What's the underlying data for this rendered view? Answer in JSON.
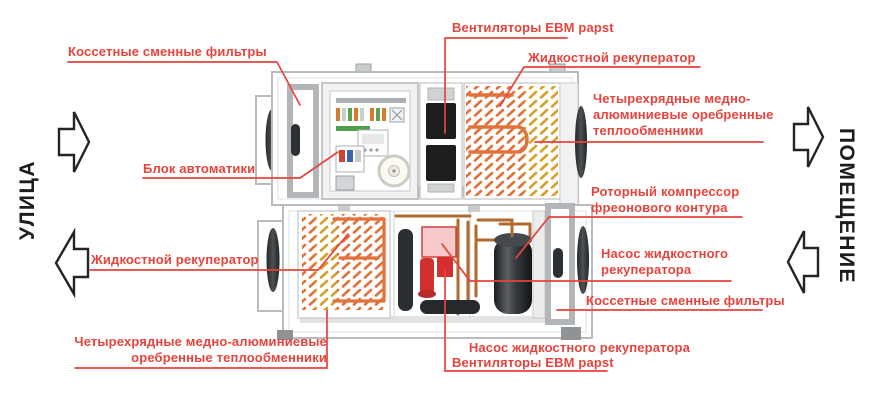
{
  "title": "Схема приточно-вытяжной установки",
  "sides": {
    "street": "УЛИЦА",
    "room": "ПОМЕЩЕНИЕ"
  },
  "labels": {
    "filters_top": "Коссетные сменные фильтры",
    "fans_top": "Вентиляторы EBM papst",
    "liquid_recuperator_top": "Жидкостной рекуператор",
    "heat_exchangers_right": {
      "lines": [
        "Четырехрядные медно-",
        "алюминиевые оребренные",
        "теплообменники"
      ]
    },
    "automation": "Блок автоматики",
    "rotary_compressor": {
      "lines": [
        "Роторный компрессор",
        "фреонового контура"
      ]
    },
    "pump_right": {
      "lines": [
        "Насос жидкостного",
        "рекуператора"
      ]
    },
    "filters_bottom": "Коссетные сменные фильтры",
    "liquid_recuperator_bottom": "Жидкостной рекуператор",
    "heat_exchangers_bottom": {
      "lines": [
        "Четырехрядные медно-алюминиевые",
        "оребренные теплообменники"
      ]
    },
    "pump_bottom": "Насос жидкостного рекуператора",
    "fans_bottom": "Вентиляторы EBM papst"
  },
  "colors": {
    "accent_red": "#e8433c",
    "casing_gray": "#b9bcbe",
    "coil_orange": "#e2713a",
    "coil_yellow": "#d2a12e",
    "copper_pipe": "#b06a2e",
    "dark_component": "#2c2f32",
    "side_text": "#1c1c1c"
  }
}
